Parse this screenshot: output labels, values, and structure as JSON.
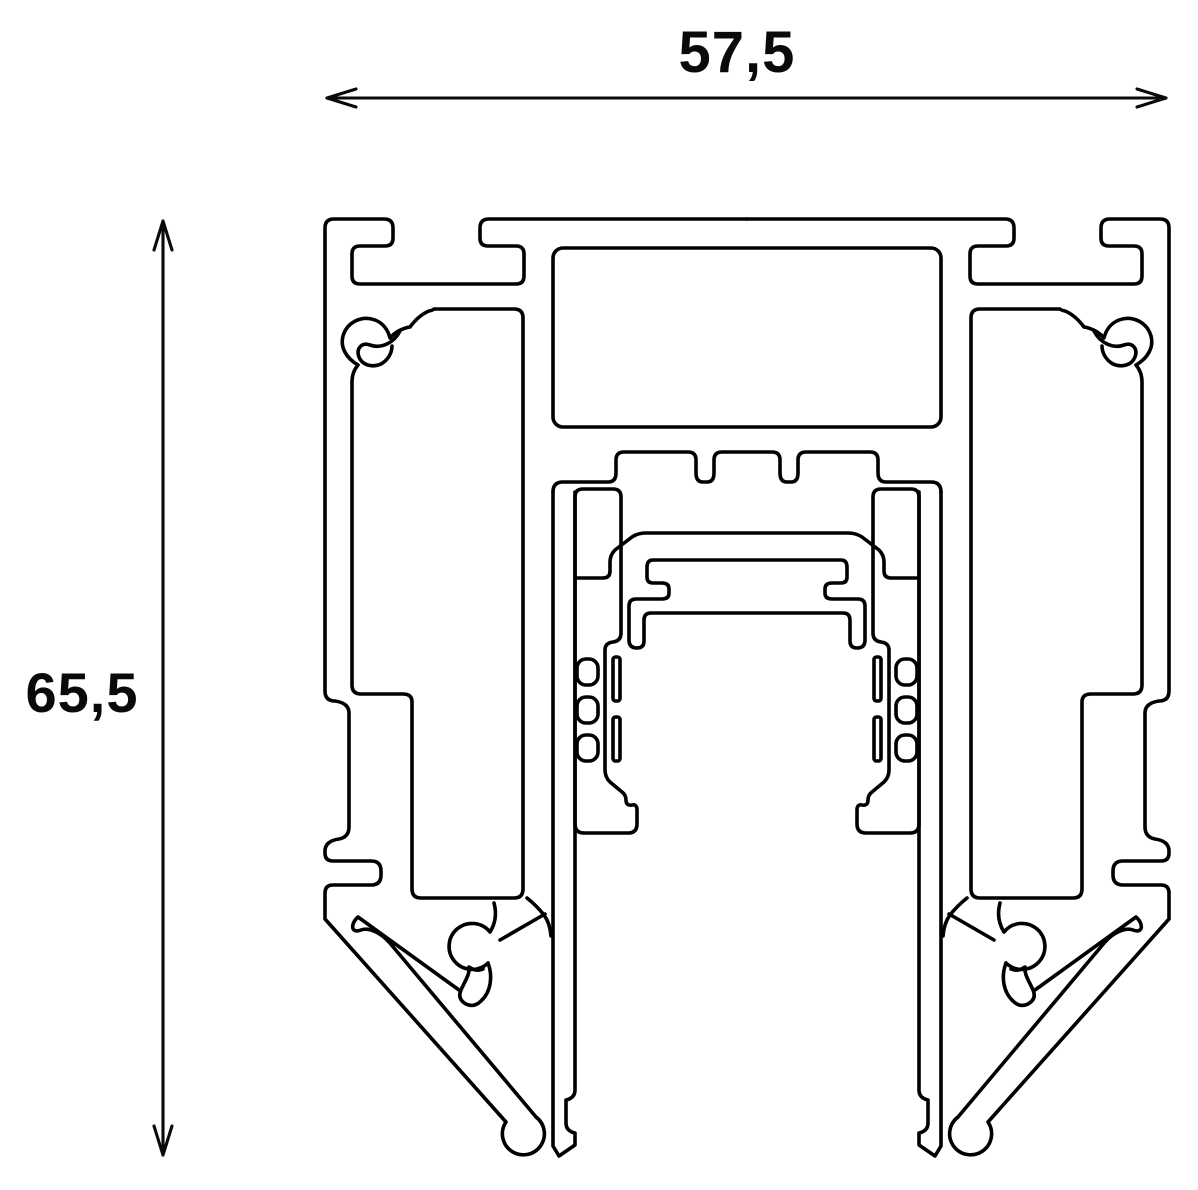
{
  "drawing": {
    "kind": "technical-cross-section",
    "subject": "extruded-track-profile",
    "line_color": "#000000",
    "background_color": "#ffffff"
  },
  "dimensions": {
    "width_label": "57,5",
    "height_label": "65,5"
  }
}
